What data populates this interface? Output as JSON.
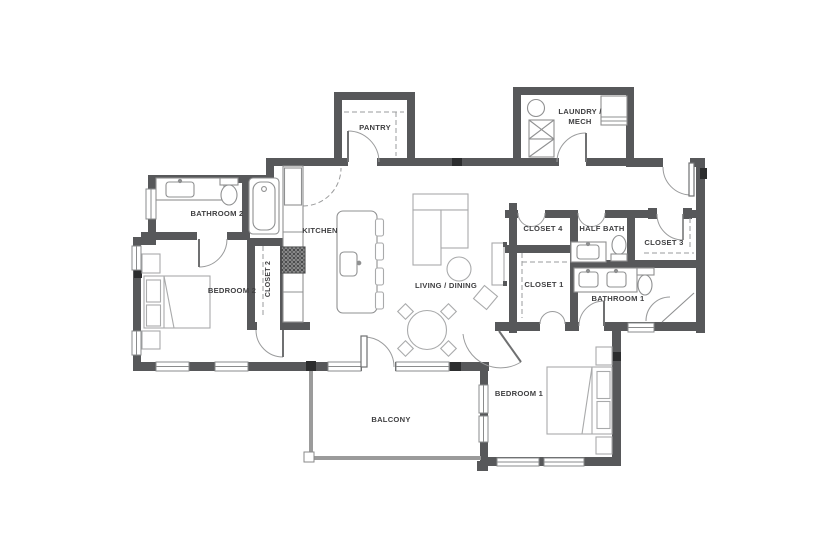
{
  "meta": {
    "type": "residential-floor-plan",
    "width": 840,
    "height": 560
  },
  "colors": {
    "wall": "#57585a",
    "post": "#2c2d2e",
    "balcony_wall": "#9b9b9b",
    "fixture_stroke": "#8f9091",
    "furniture_stroke": "#a9aaab",
    "door_arc": "#9a9b9c",
    "label_text": "#3f3f41",
    "background": "#ffffff"
  },
  "rooms": {
    "pantry": {
      "label": "PANTRY"
    },
    "laundry_mech": {
      "label_line1": "LAUNDRY /",
      "label_line2": "MECH"
    },
    "bathroom2": {
      "label": "BATHROOM 2"
    },
    "kitchen": {
      "label": "KITCHEN"
    },
    "closet2": {
      "label": "CLOSET 2"
    },
    "bedroom2": {
      "label": "BEDROOM 2"
    },
    "living_dining": {
      "label": "LIVING / DINING"
    },
    "closet4": {
      "label": "CLOSET 4"
    },
    "half_bath": {
      "label": "HALF BATH"
    },
    "closet3": {
      "label": "CLOSET 3"
    },
    "closet1": {
      "label": "CLOSET 1"
    },
    "bathroom1": {
      "label": "BATHROOM 1"
    },
    "bedroom1": {
      "label": "BEDROOM 1"
    },
    "balcony": {
      "label": "BALCONY"
    }
  },
  "fixtures": [
    "bed",
    "nightstand",
    "bathtub",
    "toilet",
    "sink",
    "double-vanity",
    "corner-shower",
    "washer",
    "dryer",
    "laundry-sink",
    "water-heater",
    "refrigerator",
    "range",
    "kitchen-island",
    "bar-stool",
    "sofa",
    "side-table",
    "dining-table",
    "dining-chair",
    "tv-console",
    "accent-table",
    "door-swing",
    "window",
    "closet-rod"
  ]
}
